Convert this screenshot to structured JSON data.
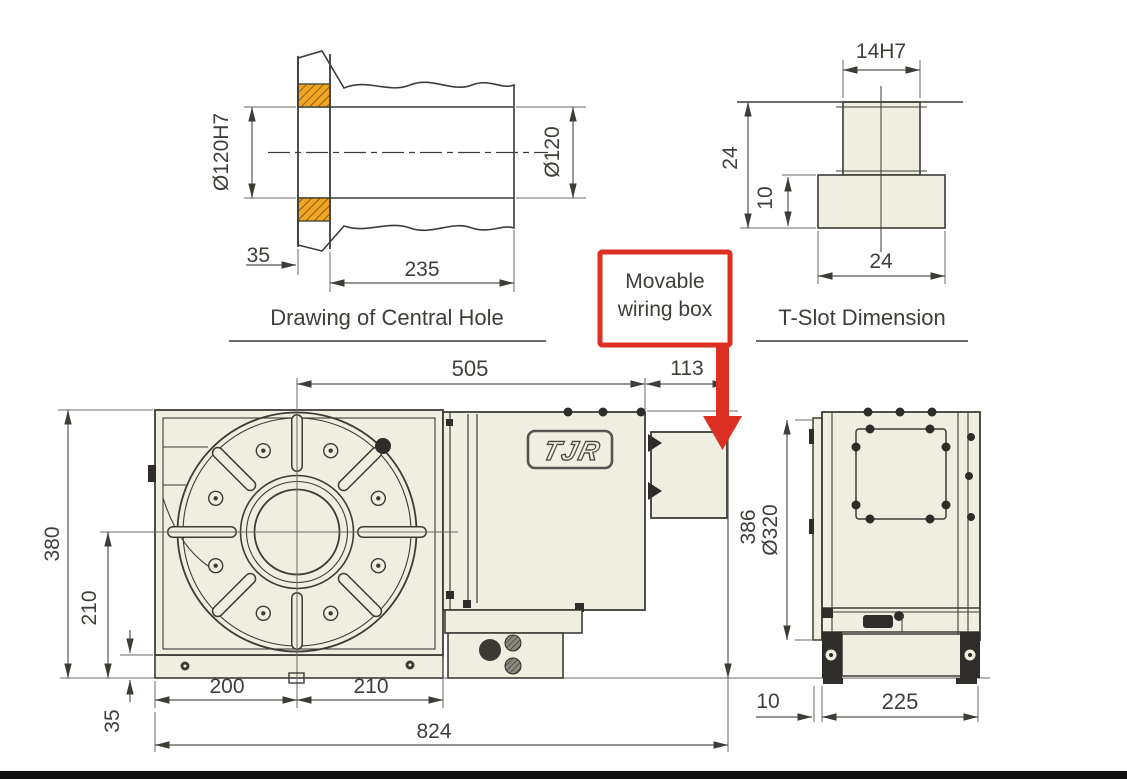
{
  "page": {
    "background": "#ffffff"
  },
  "colors": {
    "accent_red": "#dd2f22",
    "hatch_orange": "#f2a51f",
    "body_fill": "#efeee1",
    "line": "#3d3c37"
  },
  "central_hole_view": {
    "title": "Drawing of Central Hole",
    "dims": {
      "bore": "Ø120H7",
      "outer": "Ø120",
      "lip_depth": "35",
      "total_depth": "235"
    }
  },
  "t_slot_view": {
    "title": "T-Slot Dimension",
    "dims": {
      "slot_width": "14H7",
      "total_height": "24",
      "base_height": "10",
      "base_width": "24"
    }
  },
  "callout": {
    "line1": "Movable",
    "line2": "wiring box"
  },
  "front_view": {
    "logo": "TJR",
    "dims": {
      "center_to_right": "505",
      "wiring_box_width": "113",
      "overall_height": "380",
      "center_height": "210",
      "base_thickness": "35",
      "center_to_left": "200",
      "center_to_body_right": "210",
      "overall_width": "824",
      "body_height": "386"
    }
  },
  "side_view": {
    "dims": {
      "table_diameter": "Ø320",
      "face_offset": "10",
      "base_width": "225"
    }
  }
}
